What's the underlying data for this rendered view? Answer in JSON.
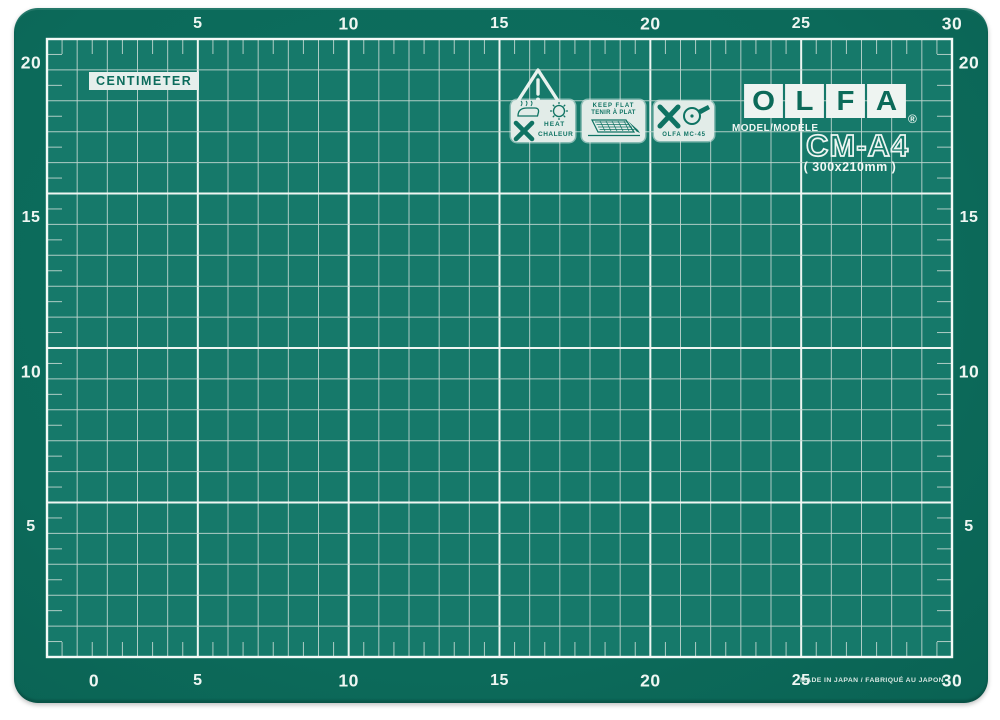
{
  "mat": {
    "unit_label": "CENTIMETER",
    "brand": {
      "letters": [
        "O",
        "L",
        "F",
        "A"
      ],
      "registered": "®"
    },
    "model_label": "MODEL/MODÈLE",
    "model_name": "CM-A4",
    "dimensions": "( 300x210mm )",
    "made_in": "MADE IN JAPAN / FABRIQUÉ AU JAPON"
  },
  "warnings": {
    "heat": {
      "en": "HEAT",
      "fr": "CHALEUR"
    },
    "keep_flat": {
      "en": "KEEP FLAT",
      "fr": "TENIR À PLAT"
    },
    "cutter_label": "OLFA MC-45"
  },
  "rulers": {
    "unit": "cm",
    "top": [
      {
        "label": "5",
        "bold": false
      },
      {
        "label": "10",
        "bold": true
      },
      {
        "label": "15",
        "bold": false
      },
      {
        "label": "20",
        "bold": true
      },
      {
        "label": "25",
        "bold": false
      },
      {
        "label": "30",
        "bold": true
      }
    ],
    "bottom": [
      {
        "label": "0",
        "bold": true
      },
      {
        "label": "5",
        "bold": false
      },
      {
        "label": "10",
        "bold": true
      },
      {
        "label": "15",
        "bold": false
      },
      {
        "label": "20",
        "bold": true
      },
      {
        "label": "25",
        "bold": false
      },
      {
        "label": "30",
        "bold": true
      }
    ],
    "left": [
      {
        "label": "20",
        "bold": true
      },
      {
        "label": "15",
        "bold": false
      },
      {
        "label": "10",
        "bold": true
      },
      {
        "label": "5",
        "bold": false
      }
    ],
    "right": [
      {
        "label": "20",
        "bold": true
      },
      {
        "label": "15",
        "bold": false
      },
      {
        "label": "10",
        "bold": true
      },
      {
        "label": "5",
        "bold": false
      }
    ]
  },
  "grid": {
    "columns": 30,
    "rows": 20,
    "major_every": 5
  },
  "colors": {
    "mat_border": "#0c6a5a",
    "grid_bg": "#16796a",
    "grid_line": "#bfd6cf",
    "grid_major_line": "#eef6f2",
    "number_color": "#eef6f2",
    "icon_ink": "#0f7363",
    "icon_bg": "#e2ece8"
  }
}
